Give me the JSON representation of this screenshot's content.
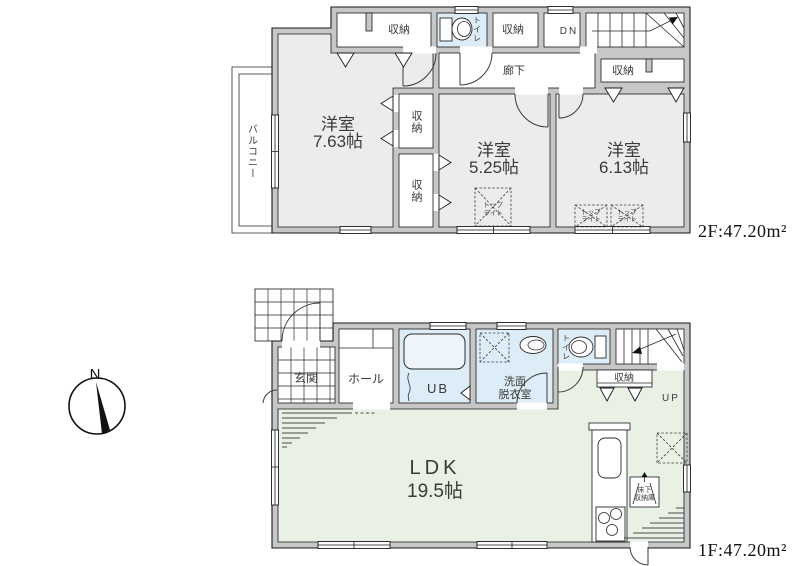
{
  "colors": {
    "wall": "#c7c7c7",
    "room": "#ececec",
    "wet": "#ddedf7",
    "ldk": "#e9f1e4",
    "line": "#1a1a1a",
    "text": "#3a3a3a",
    "accent_tub": "#eef6fc"
  },
  "compass": {
    "north_label": "N"
  },
  "floor2": {
    "area_label": "2F:47.20m²",
    "balcony_label": "バルコニー",
    "corridor_label": "廊下",
    "stairs_down_label": "DN",
    "toilet_label": "トイレ",
    "closet_label": "収納",
    "skylight_line1": "トップ",
    "skylight_line2": "ライト",
    "rooms": [
      {
        "name": "洋室",
        "size": "7.63帖"
      },
      {
        "name": "洋室",
        "size": "5.25帖"
      },
      {
        "name": "洋室",
        "size": "6.13帖"
      }
    ]
  },
  "floor1": {
    "area_label": "1F:47.20m²",
    "entrance_label": "玄関",
    "hall_label": "ホール",
    "unit_bath_label": "UB",
    "washroom_line1": "洗面",
    "washroom_line2": "脱衣室",
    "toilet_label": "トイレ",
    "closet_label": "収納",
    "stairs_up_label": "UP",
    "underfloor_storage_line1": "床下",
    "underfloor_storage_line2": "収納庫",
    "ldk": {
      "name": "LDK",
      "size": "19.5帖"
    }
  }
}
